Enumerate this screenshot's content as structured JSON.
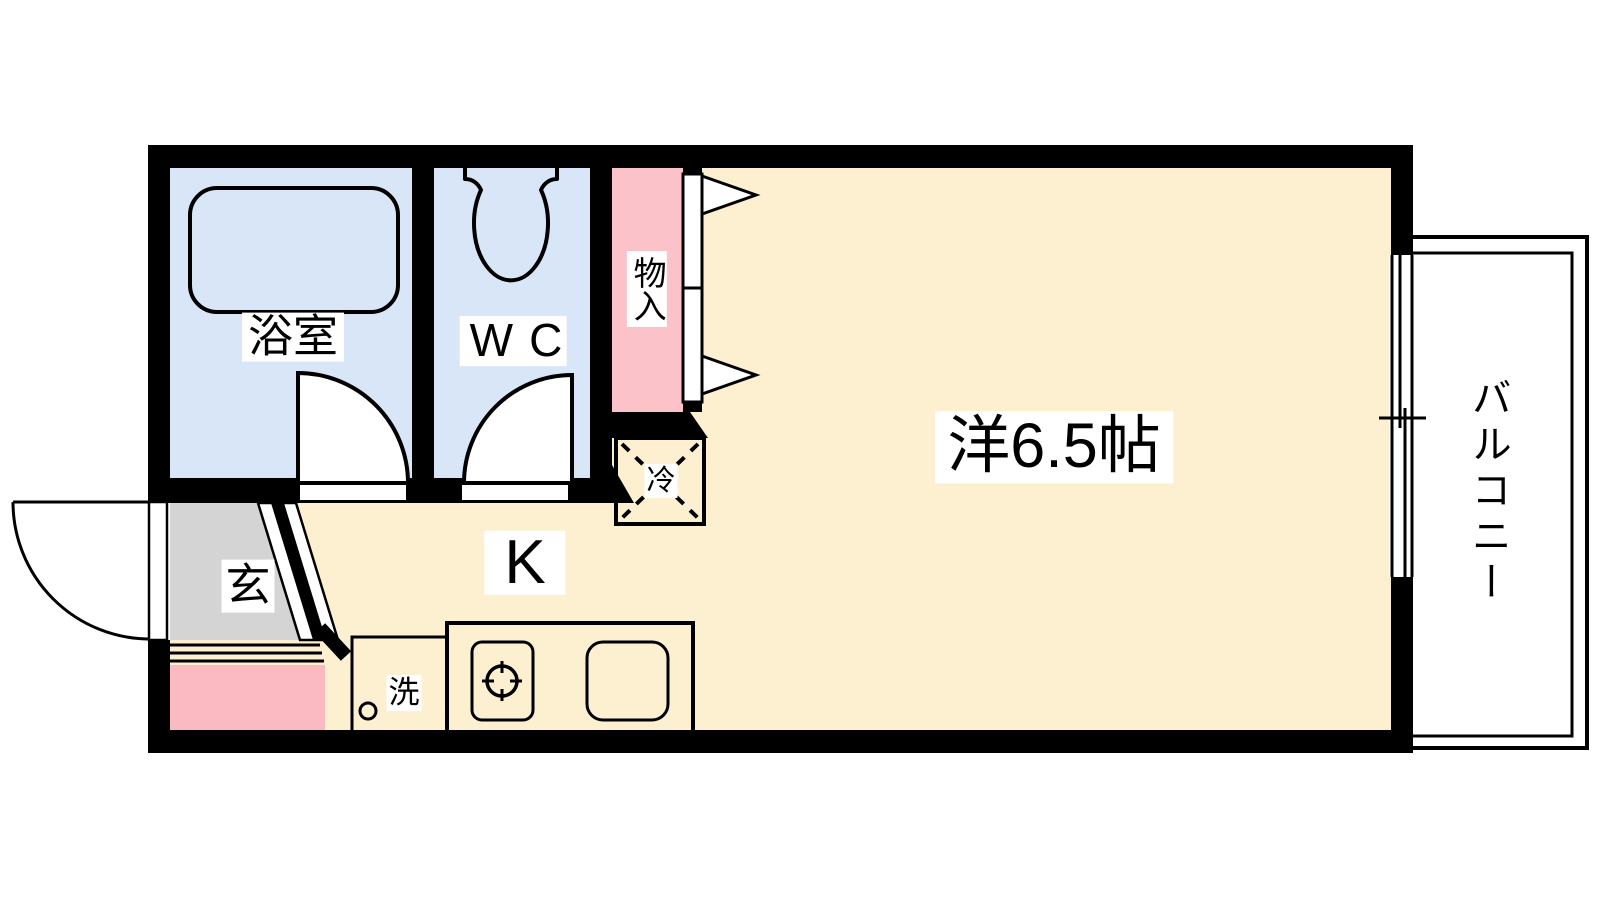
{
  "colors": {
    "wall": "#000000",
    "wet_area_fill": "#d8e6f8",
    "closet_fill": "#fbc3c9",
    "room_fill": "#fcf0d0",
    "entrance_fill": "#d4d4d4",
    "porch_fill": "#fbbac2",
    "outline": "#000000",
    "background": "#ffffff"
  },
  "rooms": {
    "bathroom": {
      "label": "浴室"
    },
    "toilet": {
      "label": "WC"
    },
    "closet": {
      "label": "物入"
    },
    "western_room": {
      "label": "洋6.5帖",
      "size_tatami": "6.5"
    },
    "kitchen": {
      "label": "K"
    },
    "entrance": {
      "label": "玄"
    },
    "balcony": {
      "label": "バルコニー"
    },
    "refrigerator_space": {
      "label": "冷"
    },
    "washing_machine_space": {
      "label": "洗"
    }
  }
}
